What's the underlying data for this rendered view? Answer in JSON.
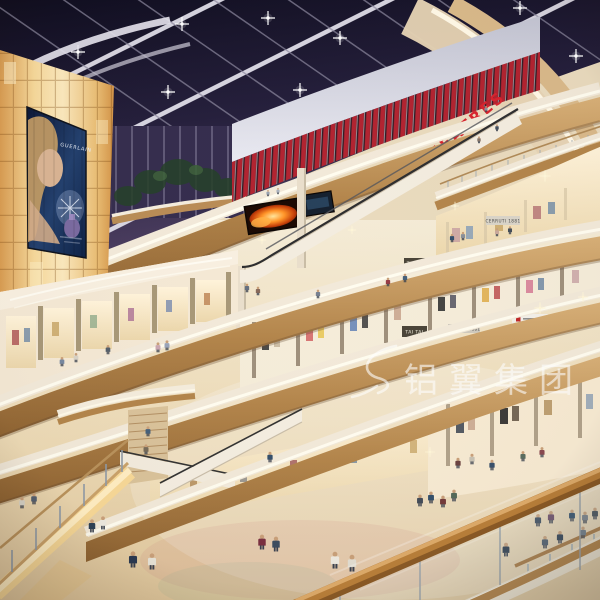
{
  "scene": {
    "description": "Multi-level shopping mall atrium interior rendering at night",
    "theatre": {
      "sign": "THEATRES"
    },
    "billboard": {
      "brand": "GUERLAIN"
    },
    "shops": {
      "upper_left_sign": "TAI TAI",
      "upper_right_sign": "CERRUTI 1881",
      "lower_left_sign": "TAI TAI",
      "lower_mid_sign": "CERRUTI 1881"
    },
    "watermark": {
      "text": "铝翼集团"
    },
    "colors": {
      "skylight": "#241f38",
      "skylight_beams": "#d9d7e4",
      "theatre_red": "#b22330",
      "theatres_letters": "#d8232e",
      "led_fire_orange": "#ff8a24",
      "backlit_wall_glow": "#f6d89a",
      "fascia_cream": "#f2e9d9",
      "wood_band": "#b3854b",
      "handrail_wood": "#a9732f",
      "floor_beige": "#e9dabd",
      "watermark_white": "#ffffff"
    }
  }
}
